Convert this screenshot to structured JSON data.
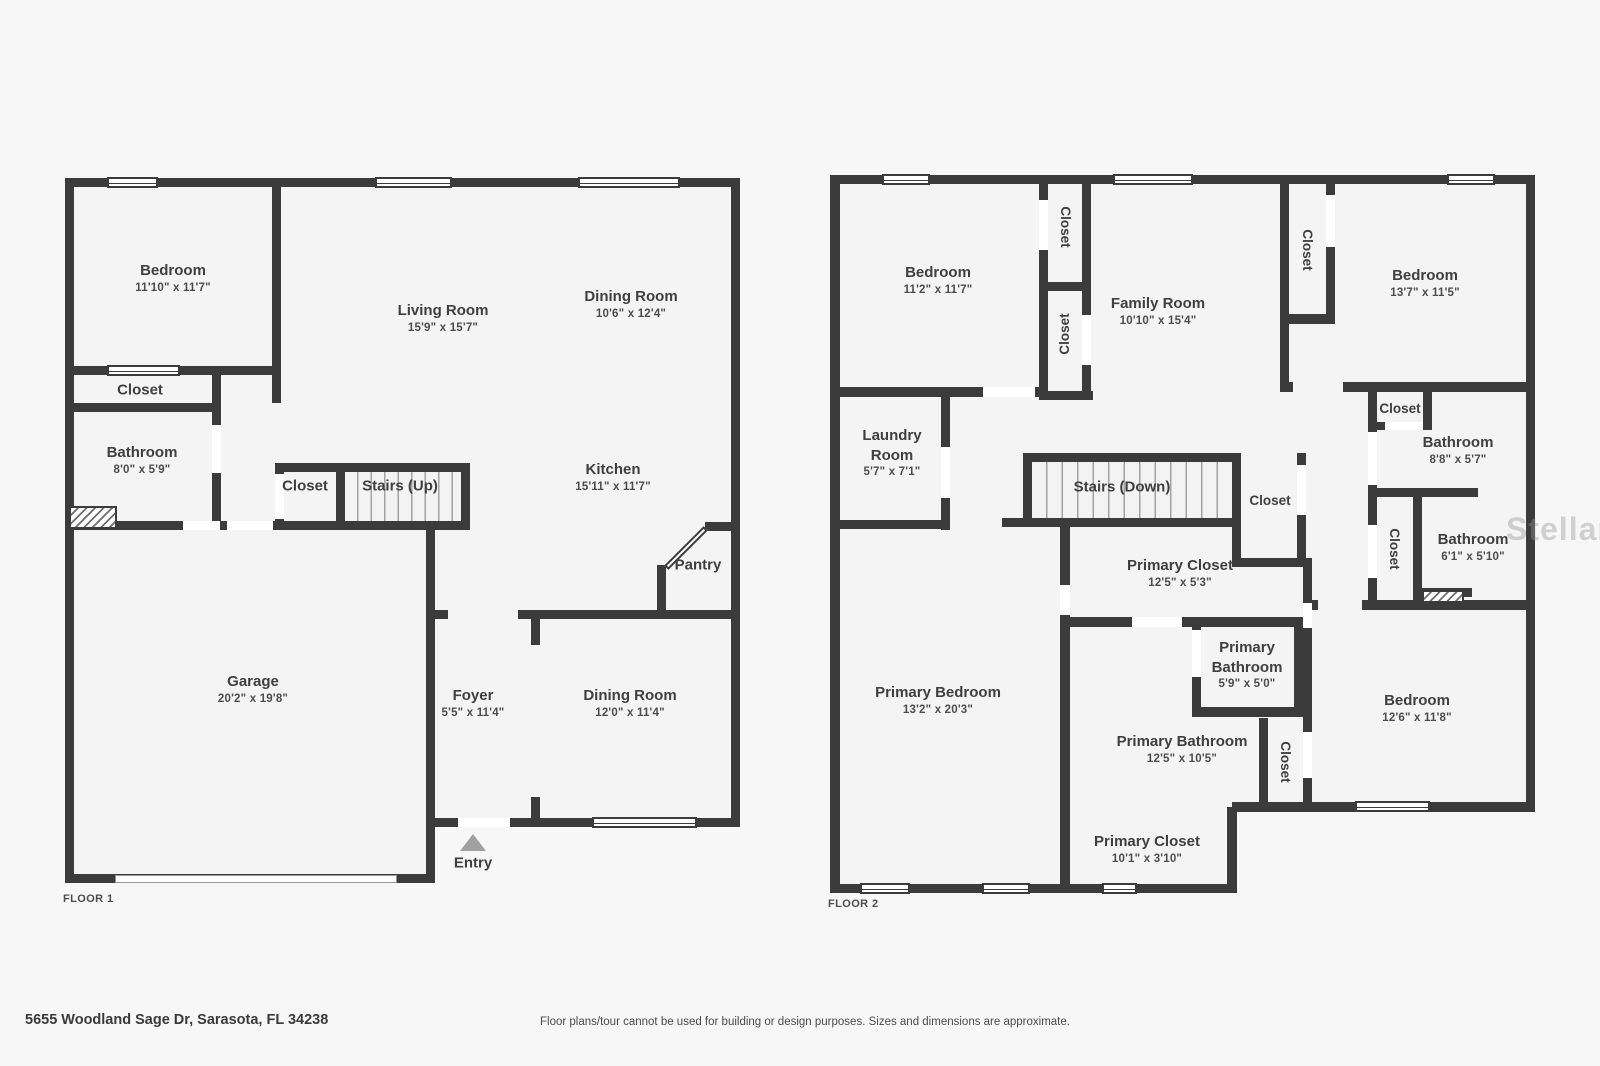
{
  "floor1": {
    "tag": "FLOOR 1",
    "bedroom": {
      "name": "Bedroom",
      "dims": "11'10\" x 11'7\""
    },
    "living": {
      "name": "Living Room",
      "dims": "15'9\" x 15'7\""
    },
    "dining_top": {
      "name": "Dining Room",
      "dims": "10'6\" x 12'4\""
    },
    "closet_a": {
      "name": "Closet"
    },
    "bathroom": {
      "name": "Bathroom",
      "dims": "8'0\" x 5'9\""
    },
    "closet_b": {
      "name": "Closet"
    },
    "stairs": {
      "name": "Stairs (Up)"
    },
    "kitchen": {
      "name": "Kitchen",
      "dims": "15'11\" x 11'7\""
    },
    "pantry": {
      "name": "Pantry"
    },
    "garage": {
      "name": "Garage",
      "dims": "20'2\" x 19'8\""
    },
    "foyer": {
      "name": "Foyer",
      "dims": "5'5\" x 11'4\""
    },
    "dining_bottom": {
      "name": "Dining Room",
      "dims": "12'0\" x 11'4\""
    },
    "entry": {
      "name": "Entry"
    }
  },
  "floor2": {
    "tag": "FLOOR 2",
    "bedroom_tl": {
      "name": "Bedroom",
      "dims": "11'2\" x 11'7\""
    },
    "closet_tl_upper": {
      "name": "Closet"
    },
    "closet_tl_lower": {
      "name": "Closet"
    },
    "family": {
      "name": "Family Room",
      "dims": "10'10\" x 15'4\""
    },
    "closet_tr": {
      "name": "Closet"
    },
    "bedroom_tr": {
      "name": "Bedroom",
      "dims": "13'7\" x 11'5\""
    },
    "laundry": {
      "name": "Laundry Room",
      "dims": "5'7\" x 7'1\""
    },
    "stairs": {
      "name": "Stairs (Down)"
    },
    "closet_stairs": {
      "name": "Closet"
    },
    "closet_small": {
      "name": "Closet"
    },
    "bathroom_top": {
      "name": "Bathroom",
      "dims": "8'8\" x 5'7\""
    },
    "closet_mid": {
      "name": "Closet"
    },
    "bathroom_right": {
      "name": "Bathroom",
      "dims": "6'1\" x 5'10\""
    },
    "primary_bedroom": {
      "name": "Primary Bedroom",
      "dims": "13'2\" x 20'3\""
    },
    "primary_closet_a": {
      "name": "Primary Closet",
      "dims": "12'5\" x 5'3\""
    },
    "primary_bath_small": {
      "name": "Primary Bathroom",
      "dims": "5'9\" x 5'0\""
    },
    "primary_bath_large": {
      "name": "Primary Bathroom",
      "dims": "12'5\" x 10'5\""
    },
    "closet_br": {
      "name": "Closet"
    },
    "bedroom_br": {
      "name": "Bedroom",
      "dims": "12'6\" x 11'8\""
    },
    "primary_closet_b": {
      "name": "Primary Closet",
      "dims": "10'1\" x 3'10\""
    }
  },
  "footer": {
    "address": "5655 Woodland Sage Dr, Sarasota, FL 34238",
    "disclaimer": "Floor plans/tour cannot be used for building or design purposes. Sizes and dimensions are approximate."
  },
  "watermark": "StellarMLS",
  "colors": {
    "wall": "#3b3b3b",
    "room_fill": "#f4f4f4",
    "background": "#f7f7f7",
    "entry_marker": "#a0a0a0"
  }
}
